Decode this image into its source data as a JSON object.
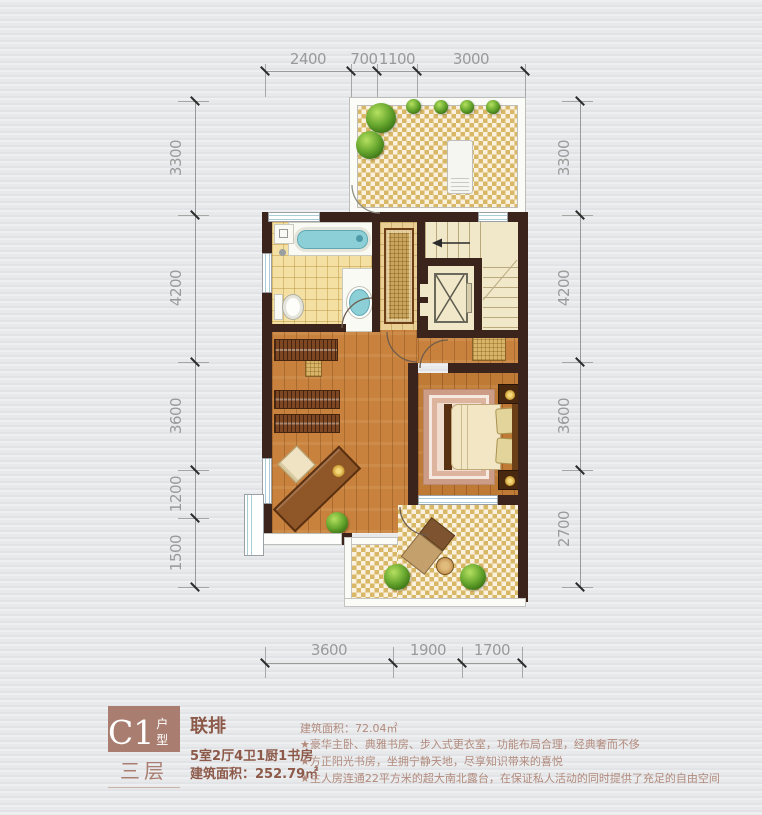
{
  "dimensions": {
    "top": [
      "2400",
      "700",
      "1100",
      "3000"
    ],
    "left": [
      "3300",
      "4200",
      "3600",
      "1200",
      "1500"
    ],
    "right": [
      "3300",
      "4200",
      "3600",
      "2700"
    ],
    "bottom": [
      "3600",
      "1900",
      "1700"
    ]
  },
  "info": {
    "unit_code": "C1",
    "unit_type_suffix": "户型",
    "floor_label": "三层",
    "product_type": "联排",
    "room_config": "5室2厅4卫1厨1书房",
    "total_area_label": "建筑面积：",
    "total_area_value": "252.79㎡",
    "floor_area_label": "建筑面积：",
    "floor_area_value": "72.04㎡",
    "features": [
      "★豪华主卧、典雅书房、步入式更衣室，功能布局合理，经典奢而不侈",
      "★方正阳光书房，坐拥宁静天地，尽享知识带来的喜悦",
      "★主人房连通22平方米的超大南北露台，在保证私人活动的同时提供了充足的自由空间"
    ]
  },
  "colors": {
    "wall": "#3b241c",
    "wood_floor": "#c8823e",
    "tile_floor": "#f4e0a2",
    "terrace_check": "#d8b766",
    "stair_floor": "#f1e7c9",
    "water_fixture": "#8ccfd6",
    "info_brown": "#a97e71",
    "text_brown": "#8d5a4a",
    "feature_text": "#b28a7c",
    "dim_text": "#9a9a9a"
  }
}
